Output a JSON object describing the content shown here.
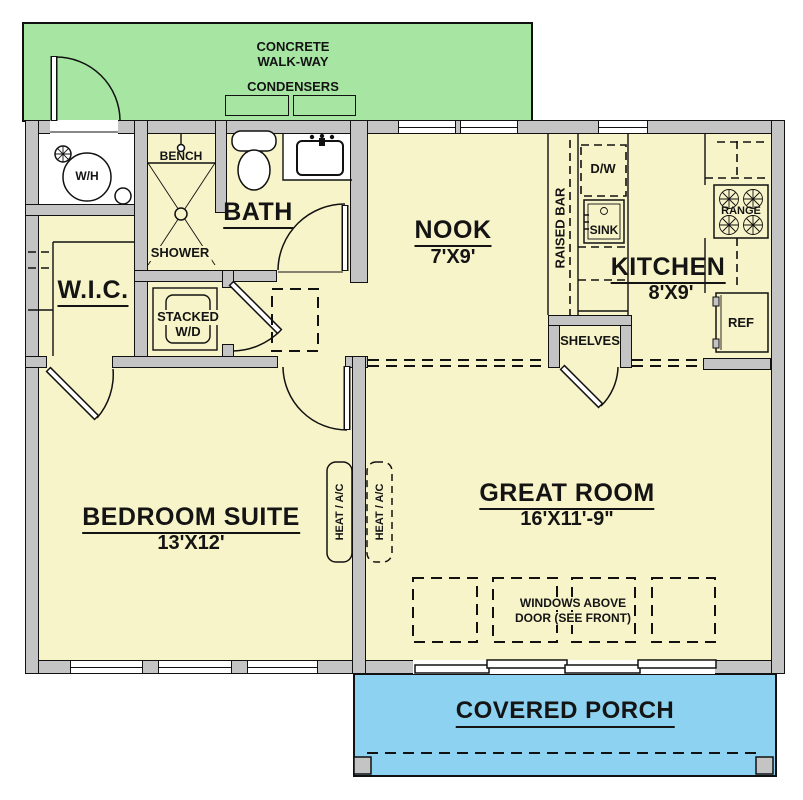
{
  "walkway": {
    "title_line1": "CONCRETE",
    "title_line2": "WALK-WAY",
    "condensers_label": "CONDENSERS"
  },
  "utility_room": {
    "water_heater_label": "W/H"
  },
  "bathroom": {
    "label": "BATH",
    "bench_label": "BENCH",
    "shower_label": "SHOWER"
  },
  "closets": {
    "wic_label": "W.I.C.",
    "stacked_wd_line1": "STACKED",
    "stacked_wd_line2": "W/D",
    "shelves_label": "SHELVES"
  },
  "hvac": {
    "left_label": "HEAT / A/C",
    "right_label": "HEAT / A/C"
  },
  "nook": {
    "label": "NOOK",
    "dimensions": "7'X9'"
  },
  "kitchen": {
    "label": "KITCHEN",
    "dimensions": "8'X9'",
    "raised_bar_label": "RAISED BAR",
    "dishwasher_label": "D/W",
    "sink_label": "SINK",
    "range_label": "RANGE",
    "refrigerator_label": "REF"
  },
  "bedroom": {
    "label": "BEDROOM SUITE",
    "dimensions": "13'X12'"
  },
  "great_room": {
    "label": "GREAT ROOM",
    "dimensions": "16'X11'-9\"",
    "windows_note_line1": "WINDOWS ABOVE",
    "windows_note_line2": "DOOR (SEE FRONT)"
  },
  "porch": {
    "label": "COVERED PORCH"
  },
  "colors": {
    "floor": "#f8f4c9",
    "walkway": "#a7e6a2",
    "porch": "#8dd2f1",
    "wall": "#c4c4c4",
    "outline": "#111111"
  }
}
